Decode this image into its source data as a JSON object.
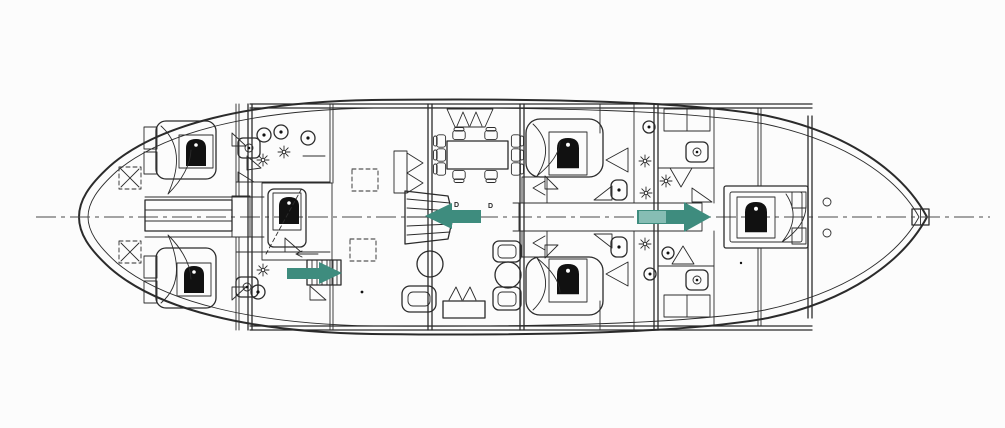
{
  "colors": {
    "paper": "#fcfcfc",
    "ink": "#2b2b2b",
    "ink_dark": "#111111",
    "arrow": "#3e8c7e",
    "arrow_highlight": "#93c6bd",
    "centerline": "#4a4a4a"
  },
  "labels": {
    "door_left": "D",
    "door_right": "D"
  },
  "arrows": {
    "salon_companionway": {
      "direction": "left"
    },
    "fore_corridor": {
      "direction": "right"
    },
    "aft_companionway": {
      "direction": "right"
    }
  },
  "icons": {
    "pillow-icon": "black arch (bed head)",
    "toilet-icon": "circle with dot",
    "sink-icon": "rounded square with basin dot",
    "light-icon": "eight-spoke star",
    "hatch-x-icon": "dashed square with X",
    "hatch-icon": "dashed square",
    "ladder-icon": "rect with rungs",
    "stairs-icon": "stepped trapezoid"
  }
}
